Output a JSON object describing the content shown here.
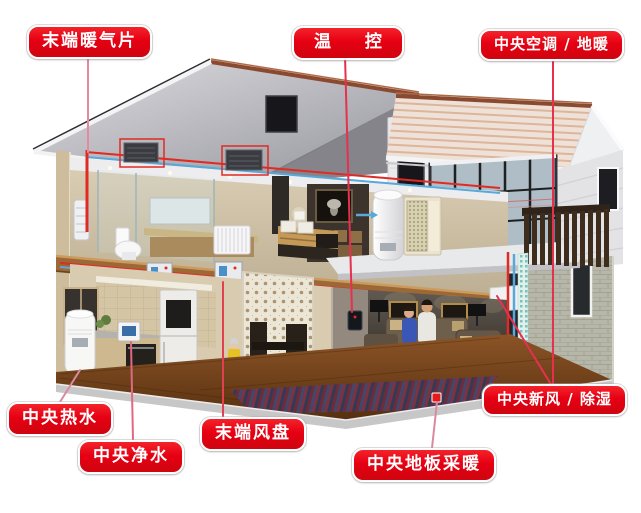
{
  "diagram": {
    "labels": [
      {
        "id": "terminal-radiator",
        "text": "末端暖气片"
      },
      {
        "id": "thermostat",
        "text": "温 控"
      },
      {
        "id": "central-ac-floor-heating",
        "text": "中央空调 / 地暖"
      },
      {
        "id": "central-hot-water",
        "text": "中央热水"
      },
      {
        "id": "central-water-purification",
        "text": "中央净水"
      },
      {
        "id": "terminal-fan-coil",
        "text": "末端风盘"
      },
      {
        "id": "central-floor-heating",
        "text": "中央地板采暖"
      },
      {
        "id": "central-fresh-air-dehumidification",
        "text": "中央新风 / 除湿"
      }
    ],
    "colors": {
      "label_background": "#e60012",
      "label_border": "#ffffff",
      "label_text": "#ffffff",
      "leader_line_pink": "#e38aa0",
      "leader_line_red": "#e6304e",
      "pipe_hot": "#e02a24",
      "pipe_cold": "#58a8d8",
      "roof_trim": "#8a4a30"
    }
  }
}
